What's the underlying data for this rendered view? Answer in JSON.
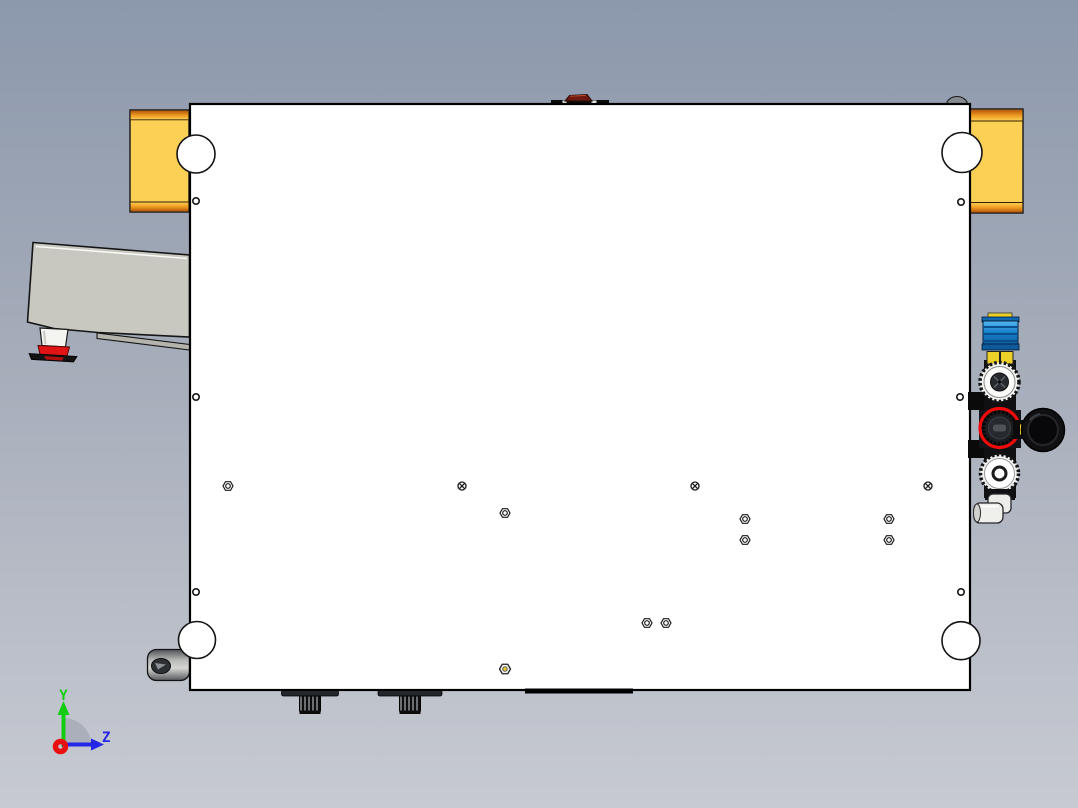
{
  "app": {
    "type": "cad-3d-viewport",
    "view": "orthographic top view of plate fixture assembly"
  },
  "colors": {
    "bg_top": "#8c98ac",
    "bg_mid": "#a6adba",
    "bg_bottom": "#c7cad2",
    "plate": "#ffffff",
    "rail_yellow": "#fccf55",
    "rail_orange": "#c25f08",
    "arm_gray": "#c8c8c1",
    "foot_red": "#e01414",
    "cap_blue": "#1a82cc",
    "hex_yellow": "#ecd028",
    "highlight_red": "#f20a0a",
    "knob_white": "#f4f4f2",
    "gauge_black": "#101012"
  },
  "triad": {
    "y_label": "Y",
    "z_label": "Z",
    "y_color": "#12cc12",
    "z_color": "#2626e8",
    "x_color": "#e81010"
  },
  "features": {
    "corner_holes": [
      {
        "cx": 196,
        "cy": 154,
        "r": 19
      },
      {
        "cx": 962,
        "cy": 152.5,
        "r": 20
      },
      {
        "cx": 197,
        "cy": 640,
        "r": 18.5
      },
      {
        "cx": 961,
        "cy": 640.7,
        "r": 19
      }
    ],
    "edge_holes": [
      {
        "cx": 196,
        "cy": 201
      },
      {
        "cx": 196,
        "cy": 397
      },
      {
        "cx": 196,
        "cy": 592
      },
      {
        "cx": 961,
        "cy": 202
      },
      {
        "cx": 960,
        "cy": 397
      },
      {
        "cx": 961,
        "cy": 592
      }
    ],
    "hex_screws": [
      {
        "cx": 228,
        "cy": 486
      },
      {
        "cx": 505,
        "cy": 513
      },
      {
        "cx": 745,
        "cy": 519
      },
      {
        "cx": 745,
        "cy": 540
      },
      {
        "cx": 889,
        "cy": 519
      },
      {
        "cx": 889,
        "cy": 540
      },
      {
        "cx": 647,
        "cy": 623
      },
      {
        "cx": 666,
        "cy": 623
      }
    ],
    "cross_screws": [
      {
        "cx": 462,
        "cy": 486
      },
      {
        "cx": 695,
        "cy": 486
      },
      {
        "cx": 928,
        "cy": 486
      }
    ],
    "brass_screw": {
      "cx": 505,
      "cy": 669
    },
    "feet": [
      {
        "cx": 310,
        "disc_w": 57
      },
      {
        "cx": 410,
        "disc_w": 64
      }
    ]
  }
}
